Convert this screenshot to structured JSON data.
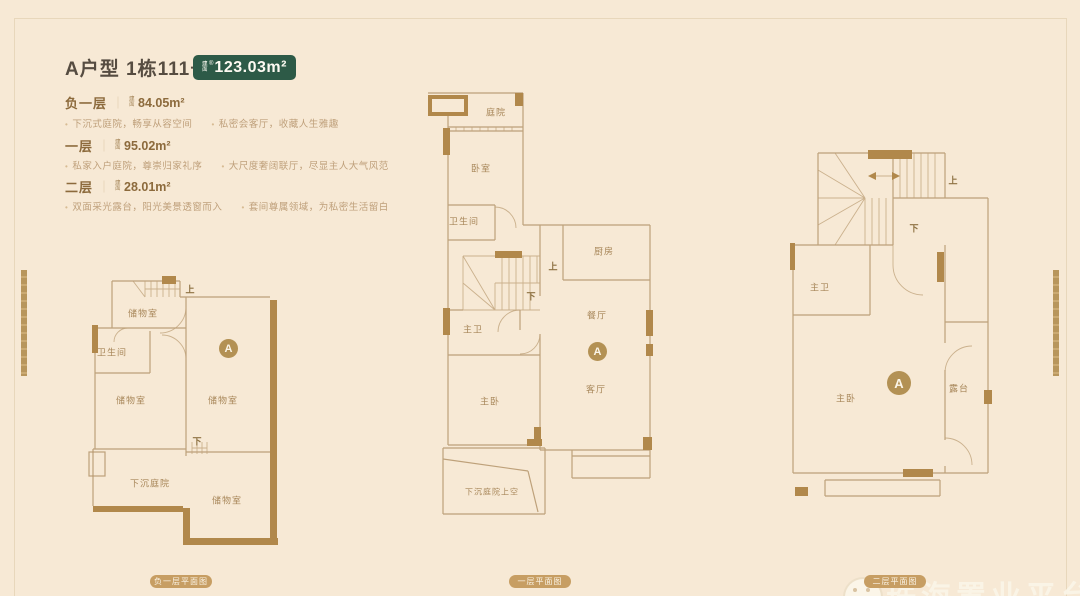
{
  "ui": {
    "bullet": "•",
    "divider": "｜"
  },
  "header": {
    "title": "A户型 1栋111号",
    "area_badge": {
      "prefix": "建面",
      "reg": "®",
      "value": "123.03m²"
    }
  },
  "sections": [
    {
      "name": "负一层",
      "prefix": "建面",
      "area": "84.05m²",
      "bullets": [
        "下沉式庭院，畅享从容空间",
        "私密会客厅，收藏人生雅趣"
      ]
    },
    {
      "name": "一层",
      "prefix": "建面",
      "area": "95.02m²",
      "bullets": [
        "私家入户庭院，尊崇归家礼序",
        "大尺度奢阔联厅，尽显主人大气风范"
      ]
    },
    {
      "name": "二层",
      "prefix": "建面",
      "area": "28.01m²",
      "bullets": [
        "双面采光露台，阳光美景透窗而入",
        "套间尊属领域，为私密生活留白"
      ]
    }
  ],
  "plans": [
    {
      "caption": "负一层平面图",
      "badge": "A",
      "up": "上",
      "down": "下",
      "rooms": [
        "储物室",
        "卫生间",
        "储物室",
        "储物室",
        "下沉庭院",
        "储物室"
      ]
    },
    {
      "caption": "一层平面图",
      "badge": "A",
      "up": "上",
      "down": "下",
      "rooms": [
        "庭院",
        "卧室",
        "卫生间",
        "厨房",
        "主卫",
        "餐厅",
        "客厅",
        "主卧",
        "下沉庭院上空"
      ]
    },
    {
      "caption": "二层平面图",
      "badge": "A",
      "up": "上",
      "down": "下",
      "rooms": [
        "主卫",
        "主卧",
        "露台"
      ]
    }
  ],
  "watermark": {
    "text": "珠海置业平台"
  }
}
